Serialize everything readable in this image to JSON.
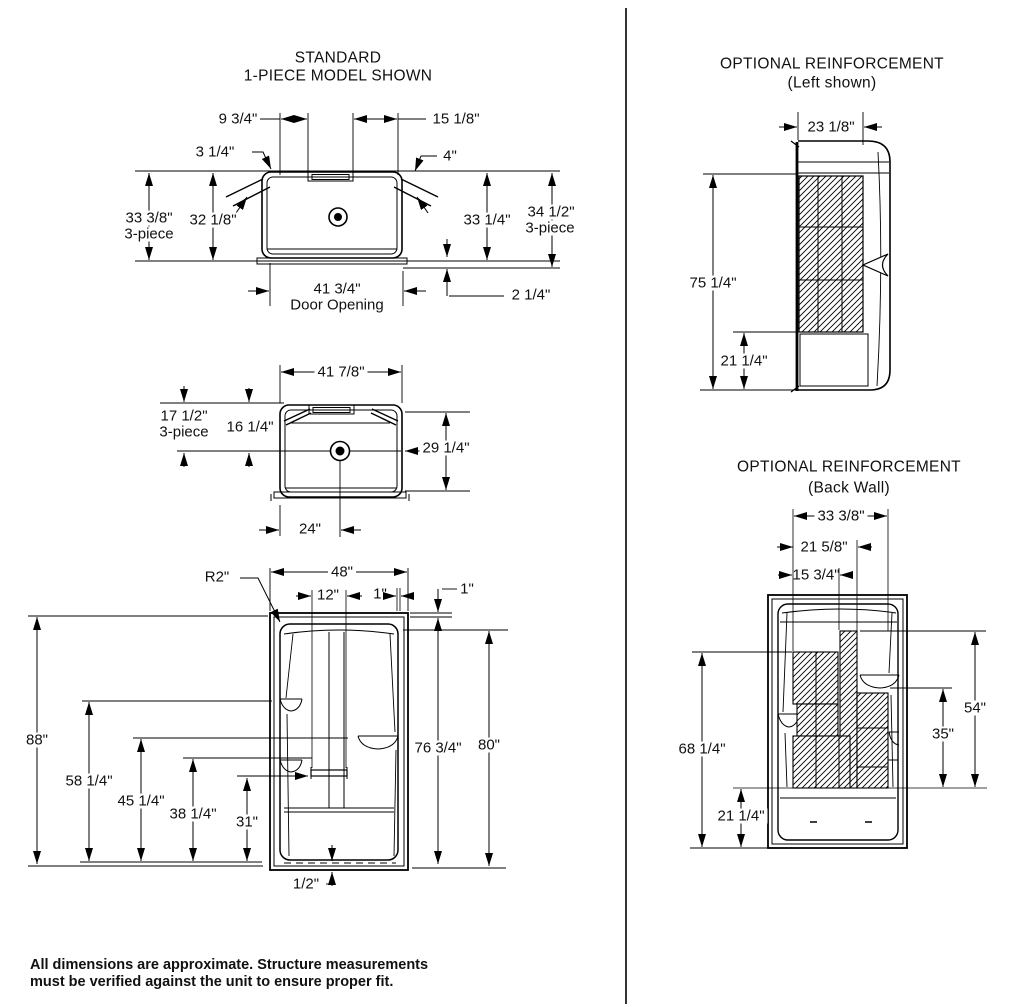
{
  "footer": {
    "line1": "All dimensions are approximate. Structure measurements",
    "line2": "must be verified against the unit to ensure proper fit."
  },
  "views": {
    "standard_plan": {
      "title1": "STANDARD",
      "title2": "1-PIECE MODEL SHOWN",
      "dims": {
        "w_left_top": "9 3/4\"",
        "w_right_top": "15 1/8\"",
        "flange_left": "3 1/4\"",
        "flange_right": "4\"",
        "h_left_outer": "33 3/8\"",
        "h_left_outer_sub": "3-piece",
        "h_left_inner": "32 1/8\"",
        "h_right_inner": "33 1/4\"",
        "h_right_outer": "34 1/2\"",
        "h_right_outer_sub": "3-piece",
        "door_opening": "41 3/4\"",
        "door_opening_sub": "Door Opening",
        "sill": "2 1/4\""
      }
    },
    "dome_plan": {
      "dims": {
        "width": "41 7/8\"",
        "h_outer": "17 1/2\"",
        "h_outer_sub": "3-piece",
        "h_inner": "16 1/4\"",
        "depth": "29 1/4\"",
        "drain": "24\""
      }
    },
    "front": {
      "dims": {
        "radius": "R2\"",
        "width": "48\"",
        "bar": "12\"",
        "wall_a": "1\"",
        "wall_b": "1\"",
        "height_total": "88\"",
        "shelf_upper": "58 1/4\"",
        "shelf_right": "45 1/4\"",
        "shelf_lower": "38 1/4\"",
        "grab_bar": "31\"",
        "threshold": "1/2\"",
        "h_inner": "76 3/4\"",
        "h_outer": "80\""
      }
    },
    "reinf_left": {
      "title1": "OPTIONAL REINFORCEMENT",
      "title2": "(Left shown)",
      "dims": {
        "width": "23 1/8\"",
        "height": "75 1/4\"",
        "bottom": "21 1/4\""
      }
    },
    "reinf_back": {
      "title1": "OPTIONAL REINFORCEMENT",
      "title2": "(Back Wall)",
      "dims": {
        "w_outer": "33 3/8\"",
        "w_mid": "21 5/8\"",
        "w_inner": "15 3/4\"",
        "h_left": "68 1/4\"",
        "h_bottom": "21 1/4\"",
        "h_right_outer": "54\"",
        "h_right_inner": "35\""
      }
    }
  }
}
